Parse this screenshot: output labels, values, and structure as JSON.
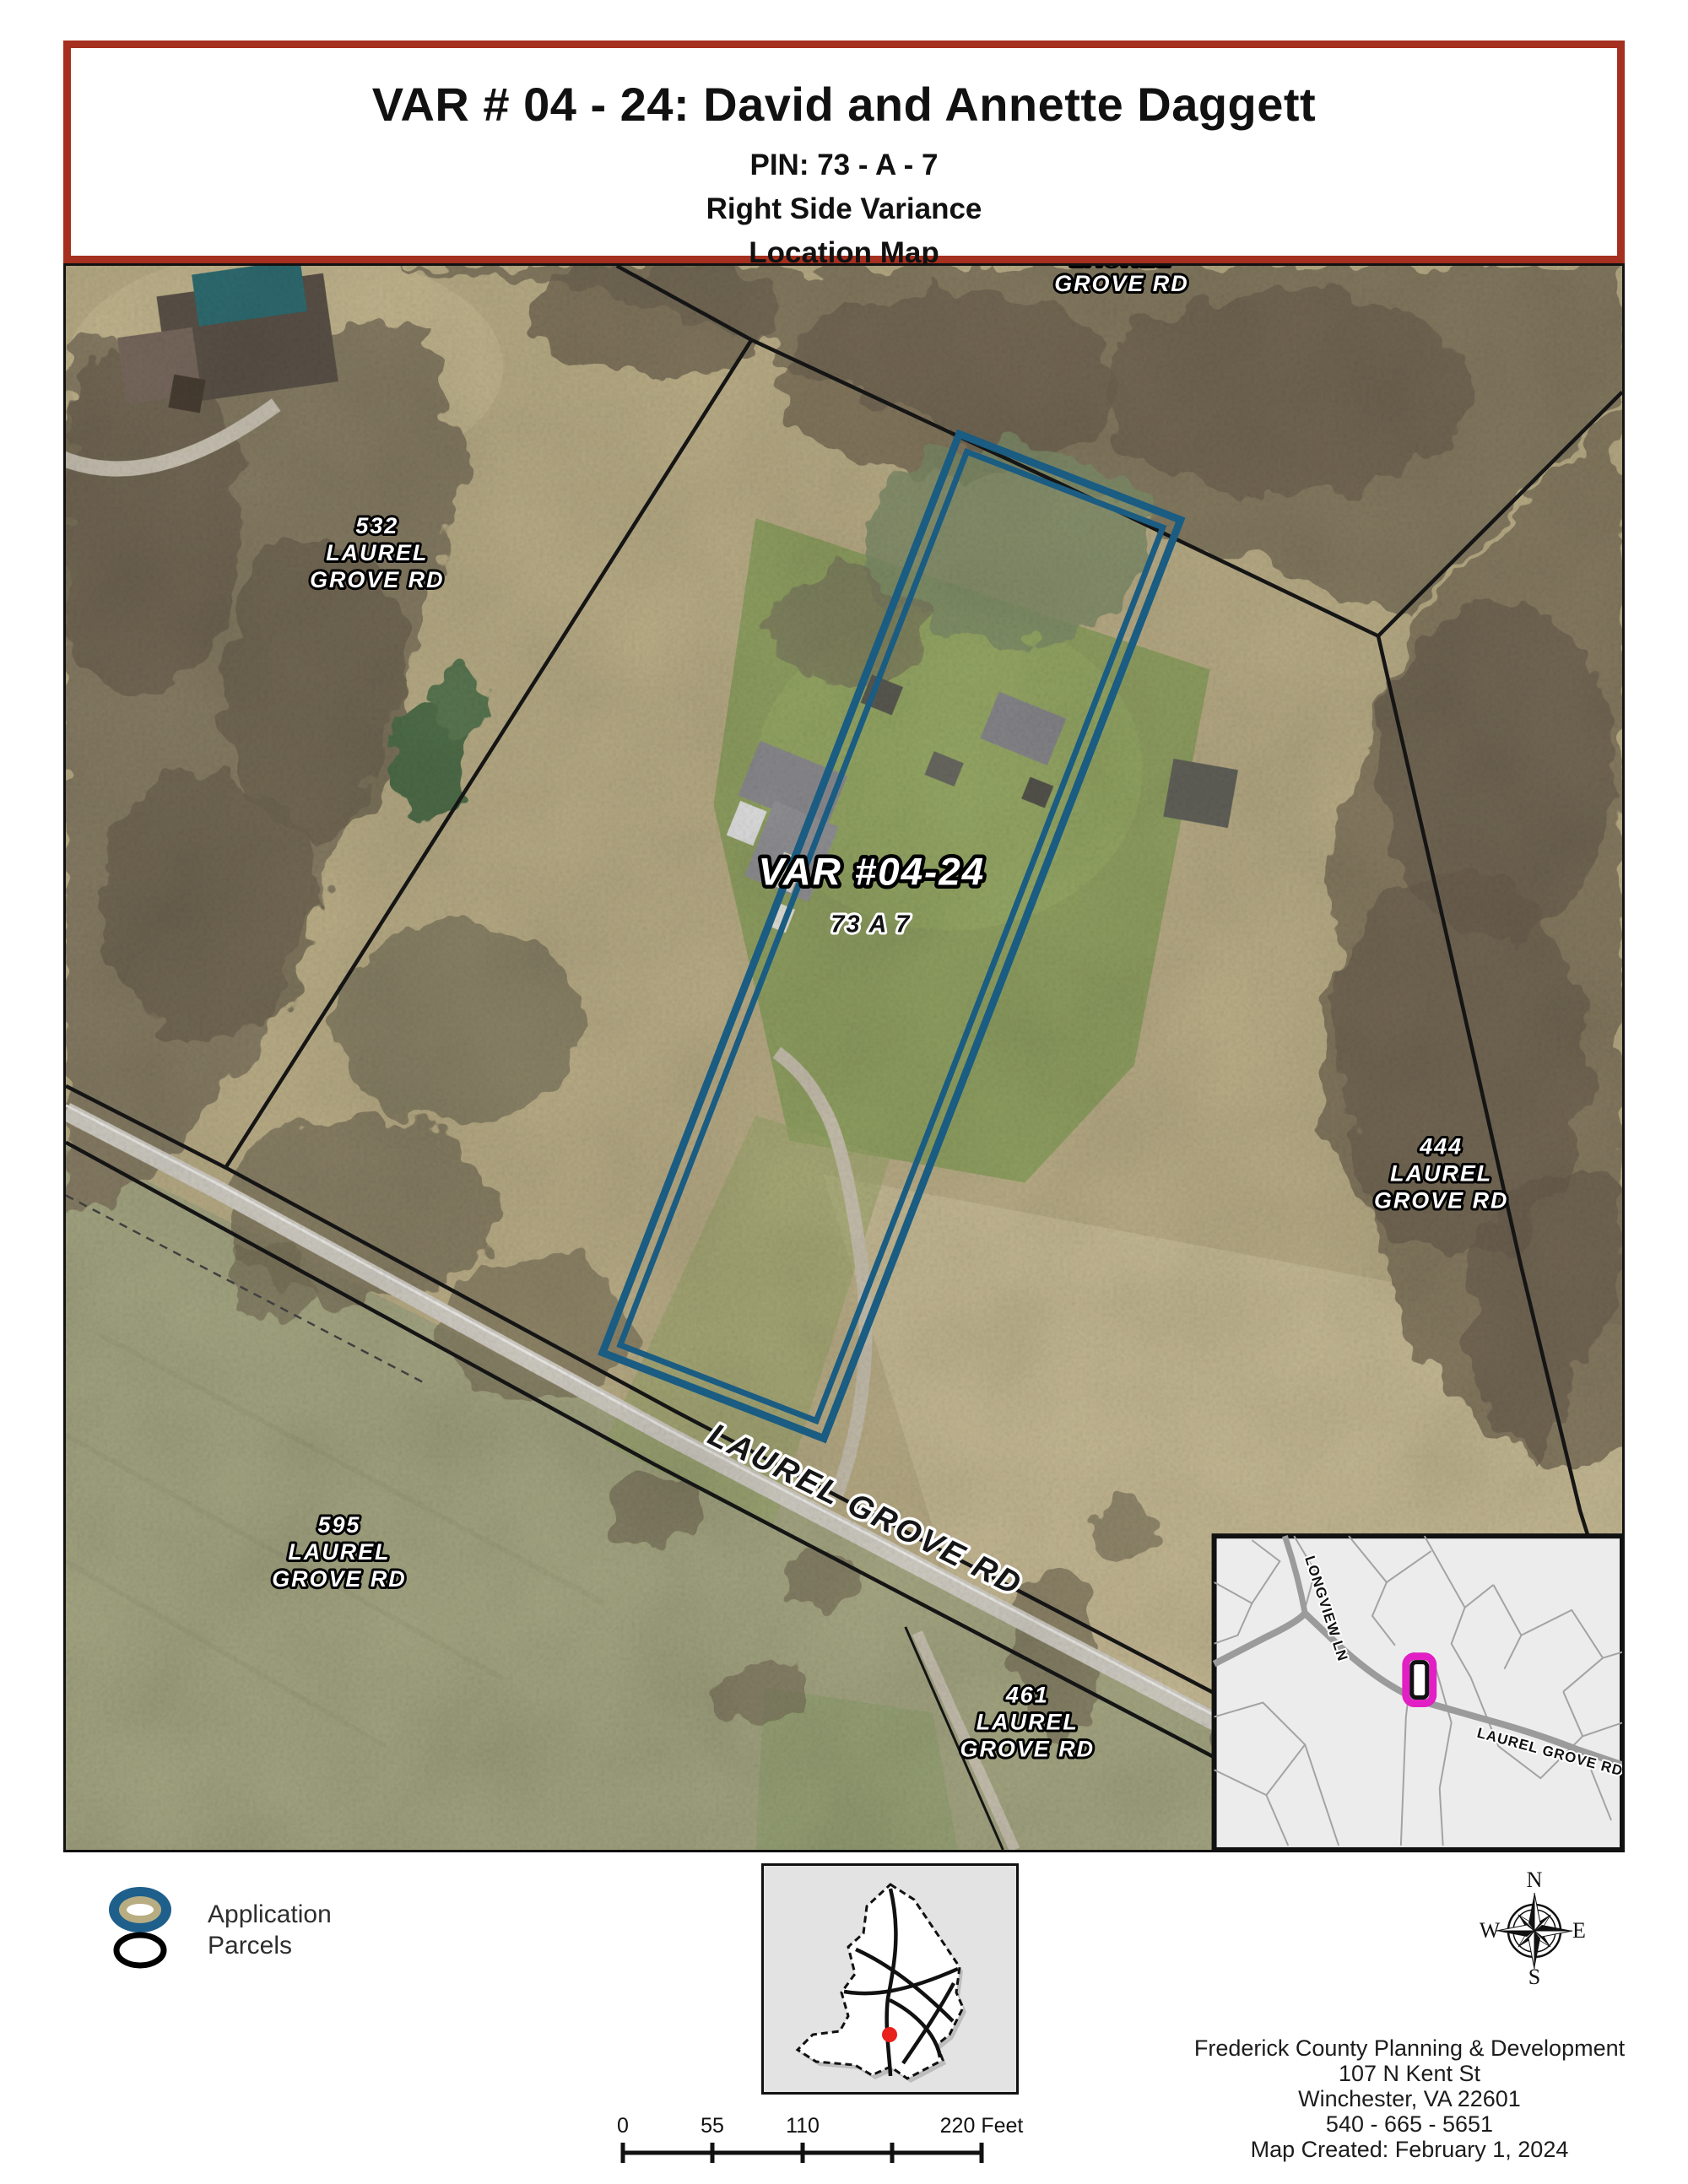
{
  "title_block": {
    "line1": "VAR # 04 - 24: David and Annette Daggett",
    "line2": "PIN: 73 - A - 7",
    "line3": "Right Side Variance",
    "line4": "Location Map"
  },
  "map": {
    "label_top": {
      "l1": "LAUREL",
      "l2": "GROVE RD"
    },
    "label_532": {
      "l1": "532",
      "l2": "LAUREL",
      "l3": "GROVE RD"
    },
    "label_subject": "VAR #04-24",
    "label_subject_pin": "73 A 7",
    "label_444": {
      "l1": "444",
      "l2": "LAUREL",
      "l3": "GROVE RD"
    },
    "label_595": {
      "l1": "595",
      "l2": "LAUREL",
      "l3": "GROVE RD"
    },
    "label_461": {
      "l1": "461",
      "l2": "LAUREL",
      "l3": "GROVE RD"
    },
    "road_label": "LAUREL GROVE RD",
    "inset": {
      "longview": "LONGVIEW LN",
      "laurel": "LAUREL GROVE RD"
    }
  },
  "legend": {
    "items": [
      {
        "label": "Application"
      },
      {
        "label": "Parcels"
      }
    ]
  },
  "compass": {
    "n": "N",
    "s": "S",
    "e": "E",
    "w": "W"
  },
  "scale_bar": {
    "ticks": [
      "0",
      "55",
      "110",
      "220 Feet"
    ]
  },
  "footer": {
    "lines": [
      "Frederick County Planning & Development",
      "107 N Kent St",
      "Winchester, VA 22601",
      "540 - 665 - 5651",
      "Map Created: February 1, 2024"
    ]
  },
  "colors": {
    "title_border_red": "#A5301F",
    "application_blue": "#1A5C82",
    "inset_highlight_magenta": "#E11FC4",
    "locator_dot_red": "#E8211D"
  }
}
